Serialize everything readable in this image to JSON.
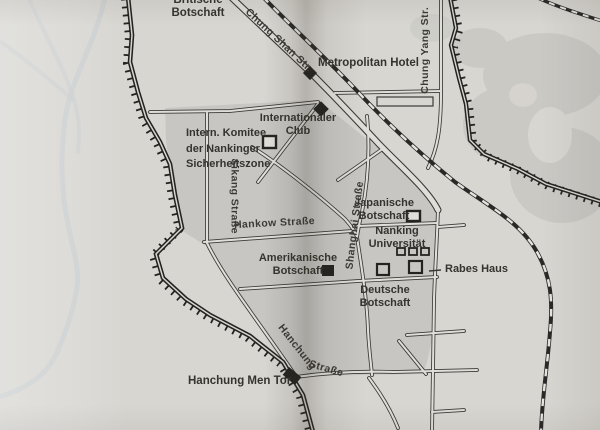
{
  "map": {
    "description": "Stadtplan von Nanking mit Sicherheitszone",
    "labels": {
      "britische_botschaft": {
        "line1": "Britische",
        "line2": "Botschaft"
      },
      "chung_shan_str": {
        "text": "Chung Shan Str."
      },
      "metropolitan_hotel": {
        "text": "Metropolitan Hotel"
      },
      "chung_yang_str": {
        "text": "Chung Yang Str."
      },
      "internationaler_club": {
        "line1": "Internationaler",
        "line2": "Club"
      },
      "komitee": {
        "line1": "Intern. Komitee",
        "line2": "der Nankinger",
        "line3": "Sicherheitszone"
      },
      "sikang_str": {
        "text": "Sikang Straße"
      },
      "hankow_str": {
        "text": "Hankow Straße"
      },
      "shanghai_str": {
        "text": "Shanghai Straße"
      },
      "japanische_botschaft": {
        "line1": "Japanische",
        "line2": "Botschaft"
      },
      "nanking_universitaet": {
        "line1": "Nanking",
        "line2": "Universität"
      },
      "amerikanische_botschaft": {
        "line1": "Amerikanische",
        "line2": "Botschaft"
      },
      "rabes_haus": {
        "text": "Rabes Haus"
      },
      "deutsche_botschaft": {
        "line1": "Deutsche",
        "line2": "Botschaft"
      },
      "hanchung_str": {
        "part1": "Hanchung",
        "part2": "Straße"
      },
      "hanchung_men_tor": {
        "text": "Hanchung Men Tor"
      }
    },
    "markers": {
      "filled_diamond": [
        "Metropolitan Hotel",
        "Internationaler Club"
      ],
      "open_square": [
        "Intern. Komitee",
        "Japanische Botschaft",
        "Nanking Universität",
        "Rabes Haus"
      ],
      "filled_square": [
        "Amerikanische Botschaft",
        "Hanchung Men Tor"
      ]
    },
    "colors": {
      "paper": "#d8d6d1",
      "safety_zone": "#c7c6c2",
      "terrain": "#cac9c4",
      "road_fill": "#e0ded9",
      "linework": "#3b3a36",
      "wall": "#242320",
      "text": "#35332e",
      "water": "#c8ccce"
    }
  }
}
